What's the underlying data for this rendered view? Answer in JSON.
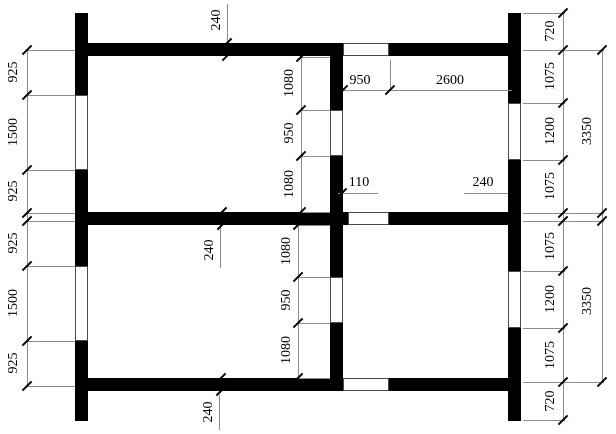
{
  "title": "Floor plan with dimension chains",
  "colors": {
    "wall": "#000000",
    "dim_line": "#8c8c8c",
    "text": "#000000",
    "background": "#ffffff"
  },
  "dims": {
    "left_chain": [
      "925",
      "1500",
      "925",
      "925",
      "1500",
      "925"
    ],
    "center_top_chain": [
      "1080",
      "950",
      "1080"
    ],
    "center_bottom_chain": [
      "1080",
      "950",
      "1080"
    ],
    "right_chain": [
      "720",
      "1075",
      "1200",
      "1075",
      "1075",
      "1200",
      "1075",
      "720"
    ],
    "right_totals": [
      "3350",
      "3350"
    ],
    "thickness_top": "240",
    "thickness_middle": "240",
    "thickness_bottom": "240",
    "top_room_widths": [
      "950",
      "2600"
    ],
    "door_offsets": [
      "110",
      "240"
    ]
  }
}
